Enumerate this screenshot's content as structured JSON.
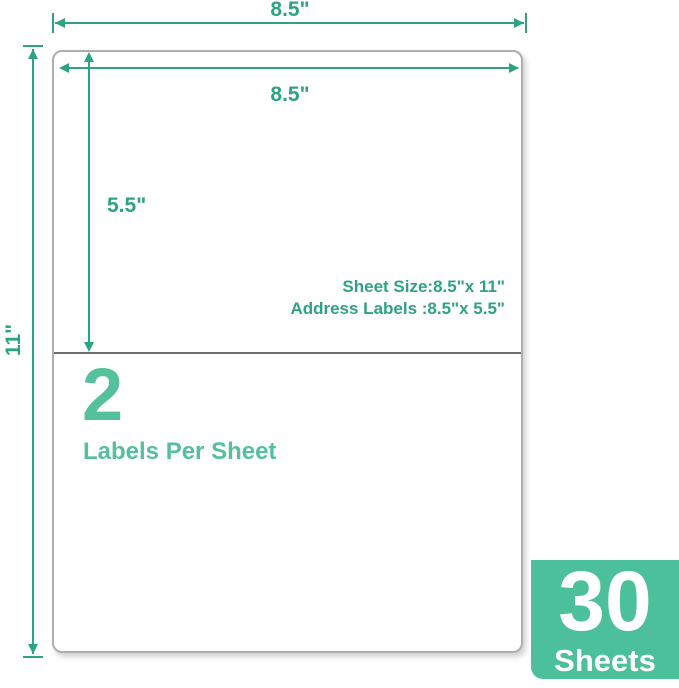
{
  "colors": {
    "dimension": "#2ea383",
    "accent_light": "#55c19a",
    "badge_bg": "#4cc09a",
    "badge_text": "#ffffff",
    "sheet_border": "#aeaeae",
    "divider": "#6e6e6e"
  },
  "dimensions": {
    "outer_width_label": "8.5\"",
    "outer_height_label": "11\"",
    "inner_width_label": "8.5\"",
    "label_height_label": "5.5\""
  },
  "specs": {
    "sheet_size_line": "Sheet Size:8.5\"x 11\"",
    "address_labels_line": "Address Labels :8.5\"x 5.5\""
  },
  "label_info": {
    "count": "2",
    "caption": "Labels Per Sheet"
  },
  "badge": {
    "count": "30",
    "unit": "Sheets"
  }
}
